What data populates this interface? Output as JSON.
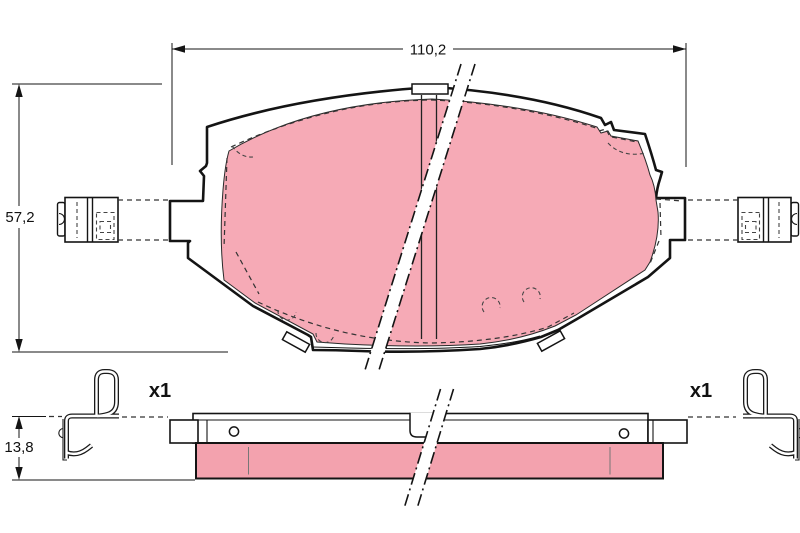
{
  "labels": {
    "dim_width": "110,2",
    "dim_height": "57,2",
    "dim_thickness": "13,8",
    "qty_left": "x1",
    "qty_right": "x1"
  },
  "colors": {
    "friction_front": "#f6aab6",
    "friction_side": "#f3a2ae",
    "line": "#141414",
    "background": "#ffffff"
  }
}
